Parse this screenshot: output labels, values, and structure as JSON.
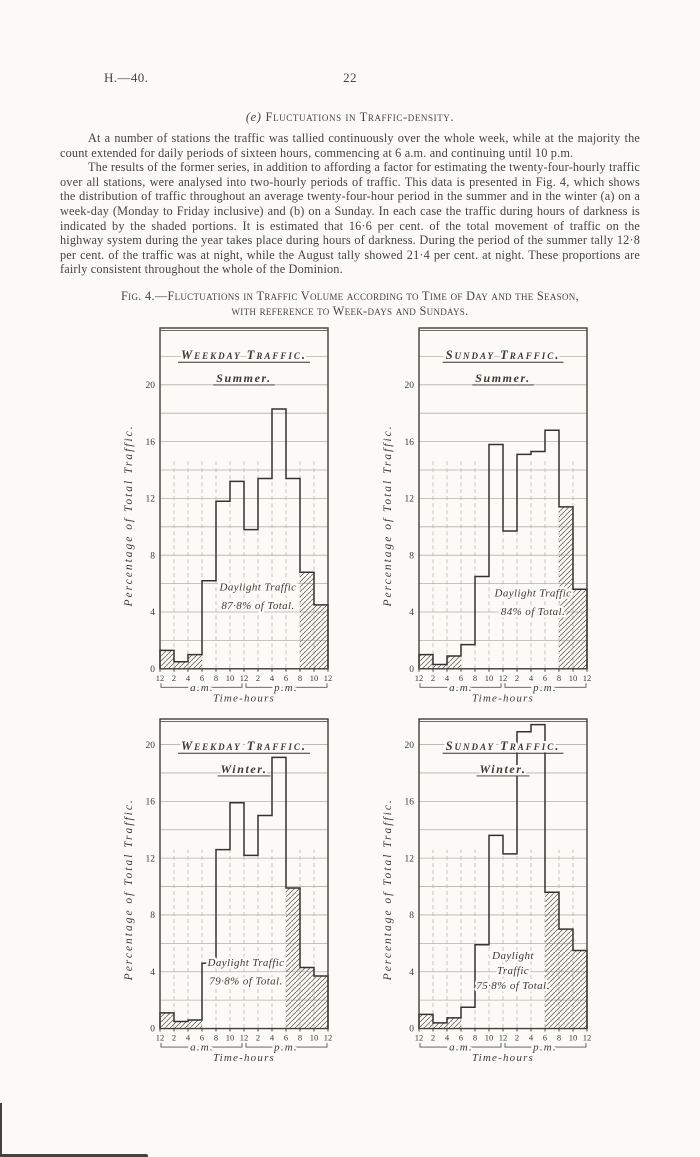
{
  "page": {
    "doc_ref": "H.—40.",
    "page_number": "22",
    "heading_index": "(e)",
    "heading_text": "Fluctuations in Traffic-density.",
    "paragraph1": "At a number of stations the traffic was tallied continuously over the whole week, while at the majority the count extended for daily periods of sixteen hours, commencing at 6 a.m. and continuing until 10 p.m.",
    "paragraph2": "The results of the former series, in addition to affording a factor for estimating the twenty-four-hourly traffic over all stations, were analysed into two-hourly periods of traffic.  This data is presented in Fig. 4, which shows the distribution of traffic throughout an average twenty-four-hour period in the summer and in the winter (a) on a week-day (Monday to Friday inclusive) and (b) on a Sunday.  In each case the traffic during hours of darkness is indicated by the shaded portions.  It is estimated that 16·6 per cent. of the total movement of traffic on the highway system during the year takes place during hours of darkness.  During the period of the summer tally 12·8 per cent. of the traffic was at night, while the August tally showed 21·4 per cent. at night.  These proportions are fairly consistent throughout the whole of the Dominion.",
    "figure_caption_line1": "Fig. 4.—Fluctuations in Traffic Volume according to Time of Day and the Season,",
    "figure_caption_line2": "with reference to Week-days and Sundays."
  },
  "chart_data": [
    {
      "type": "bar",
      "title": "Weekday Traffic.",
      "subtitle": "Summer.",
      "ylabel": "Percentage of Total Traffic.",
      "xlabel": "Time-hours",
      "am_label": "a.m.",
      "pm_label": "p.m.",
      "x_tick_labels": [
        "12",
        "2",
        "4",
        "6",
        "8",
        "10",
        "12",
        "2",
        "4",
        "6",
        "8",
        "10",
        "12"
      ],
      "categories": [
        "12-2 a.m.",
        "2-4 a.m.",
        "4-6 a.m.",
        "6-8 a.m.",
        "8-10 a.m.",
        "10-12 a.m.",
        "12-2 p.m.",
        "2-4 p.m.",
        "4-6 p.m.",
        "6-8 p.m.",
        "8-10 p.m.",
        "10-12 p.m."
      ],
      "values": [
        1.3,
        0.5,
        1.0,
        6.2,
        11.8,
        13.2,
        9.8,
        13.4,
        18.3,
        13.4,
        6.8,
        4.5
      ],
      "night_bins": [
        0,
        1,
        2,
        10,
        11
      ],
      "annotation": [
        "Daylight Traffic",
        "87·8% of Total."
      ],
      "annotation_v": 5.5,
      "annotation_dx": 14,
      "ylim": [
        0,
        24
      ],
      "yticks": [
        0,
        4,
        8,
        12,
        16,
        20
      ],
      "grid_step": 2,
      "dash_top": 14.8,
      "legend": "shaded portions indicate hours of darkness"
    },
    {
      "type": "bar",
      "title": "Sunday Traffic.",
      "subtitle": "Summer.",
      "ylabel": "Percentage of Total Traffic.",
      "xlabel": "Time-hours",
      "am_label": "a.m.",
      "pm_label": "p.m.",
      "x_tick_labels": [
        "12",
        "2",
        "4",
        "6",
        "8",
        "10",
        "12",
        "2",
        "4",
        "6",
        "8",
        "10",
        "12"
      ],
      "categories": [
        "12-2 a.m.",
        "2-4 a.m.",
        "4-6 a.m.",
        "6-8 a.m.",
        "8-10 a.m.",
        "10-12 a.m.",
        "12-2 p.m.",
        "2-4 p.m.",
        "4-6 p.m.",
        "6-8 p.m.",
        "8-10 p.m.",
        "10-12 p.m."
      ],
      "values": [
        1.0,
        0.3,
        0.9,
        1.7,
        6.5,
        15.8,
        9.7,
        15.1,
        15.3,
        16.8,
        11.4,
        5.6
      ],
      "night_bins": [
        0,
        1,
        2,
        10,
        11
      ],
      "annotation": [
        "Daylight Traffic",
        "84% of Total."
      ],
      "annotation_v": 5.1,
      "annotation_dx": 30,
      "ylim": [
        0,
        24
      ],
      "yticks": [
        0,
        4,
        8,
        12,
        16,
        20
      ],
      "grid_step": 2,
      "dash_top": 14.8,
      "legend": "shaded portions indicate hours of darkness"
    },
    {
      "type": "bar",
      "title": "Weekday Traffic.",
      "subtitle": "Winter.",
      "ylabel": "Percentage of Total Traffic.",
      "xlabel": "Time-hours",
      "am_label": "a.m.",
      "pm_label": "p.m.",
      "x_tick_labels": [
        "12",
        "2",
        "4",
        "6",
        "8",
        "10",
        "12",
        "2",
        "4",
        "6",
        "8",
        "10",
        "12"
      ],
      "categories": [
        "12-2 a.m.",
        "2-4 a.m.",
        "4-6 a.m.",
        "6-8 a.m.",
        "8-10 a.m.",
        "10-12 a.m.",
        "12-2 p.m.",
        "2-4 p.m.",
        "4-6 p.m.",
        "6-8 p.m.",
        "8-10 p.m.",
        "10-12 p.m."
      ],
      "values": [
        1.1,
        0.5,
        0.6,
        4.6,
        12.6,
        15.9,
        12.2,
        15.0,
        19.1,
        9.9,
        4.3,
        3.7
      ],
      "night_bins": [
        0,
        1,
        2,
        9,
        10,
        11
      ],
      "annotation": [
        "Daylight Traffic",
        "79·8% of Total."
      ],
      "annotation_v": 4.4,
      "annotation_dx": 2,
      "ylim": [
        0,
        21.8
      ],
      "yticks": [
        0,
        4,
        8,
        12,
        16,
        20
      ],
      "grid_step": 2,
      "dash_top": 12.6,
      "legend": "shaded portions indicate hours of darkness"
    },
    {
      "type": "bar",
      "title": "Sunday Traffic.",
      "subtitle": "Winter.",
      "ylabel": "Percentage of Total Traffic.",
      "xlabel": "Time-hours",
      "am_label": "a.m.",
      "pm_label": "p.m.",
      "x_tick_labels": [
        "12",
        "2",
        "4",
        "6",
        "8",
        "10",
        "12",
        "2",
        "4",
        "6",
        "8",
        "10",
        "12"
      ],
      "categories": [
        "12-2 a.m.",
        "2-4 a.m.",
        "4-6 a.m.",
        "6-8 a.m.",
        "8-10 a.m.",
        "10-12 a.m.",
        "12-2 p.m.",
        "2-4 p.m.",
        "4-6 p.m.",
        "6-8 p.m.",
        "8-10 p.m.",
        "10-12 p.m."
      ],
      "values": [
        1.0,
        0.4,
        0.75,
        1.5,
        5.9,
        13.6,
        12.3,
        20.9,
        21.4,
        9.6,
        7.0,
        5.5
      ],
      "night_bins": [
        0,
        1,
        2,
        9,
        10,
        11
      ],
      "annotation": [
        "Daylight",
        "Traffic",
        "75·8% of Total."
      ],
      "annotation_v": 4.9,
      "annotation_dx": 10,
      "ylim": [
        0,
        21.8
      ],
      "yticks": [
        0,
        4,
        8,
        12,
        16,
        20
      ],
      "grid_step": 2,
      "dash_top": 12.6,
      "legend": "shaded portions indicate hours of darkness"
    }
  ]
}
